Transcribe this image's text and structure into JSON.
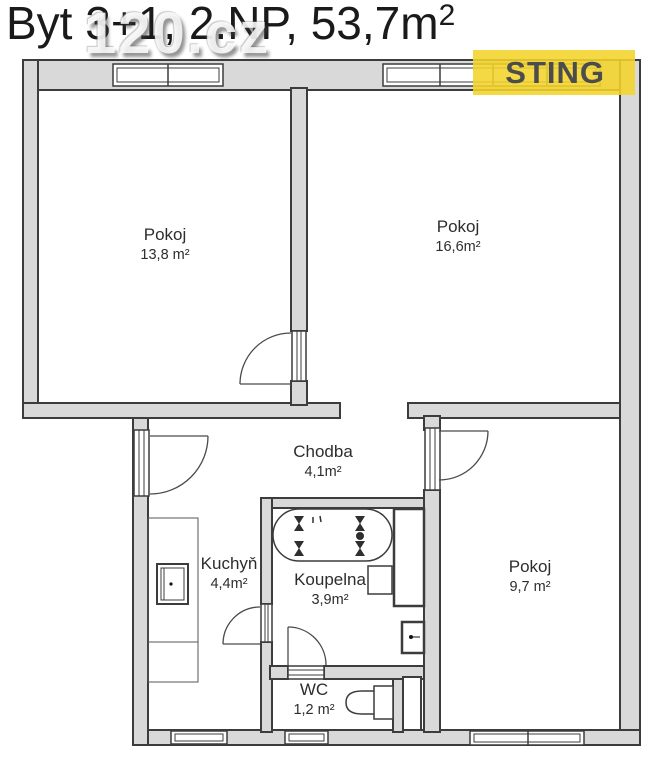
{
  "title_main": "Byt 3+1, 2.NP, 53,7m",
  "title_sup": "2",
  "watermark_text": "120.cz",
  "logo": {
    "text": "STING",
    "bg_color": "#f3d32a",
    "text_color": "#4c4c4c"
  },
  "rooms": {
    "pokoj1": {
      "name": "Pokoj",
      "area": "13,8 m²"
    },
    "pokoj2": {
      "name": "Pokoj",
      "area": "16,6m²"
    },
    "pokoj3": {
      "name": "Pokoj",
      "area": "9,7 m²"
    },
    "chodba": {
      "name": "Chodba",
      "area": "4,1m²"
    },
    "kuchyn": {
      "name": "Kuchyň",
      "area": "4,4m²"
    },
    "koupelna": {
      "name": "Koupelna",
      "area": "3,9m²"
    },
    "wc": {
      "name": "WC",
      "area": "1,2 m²"
    }
  },
  "plan_colors": {
    "wall_fill": "#d9d9d9",
    "wall_stroke": "#3c3c3c",
    "room_fill": "#ffffff"
  }
}
